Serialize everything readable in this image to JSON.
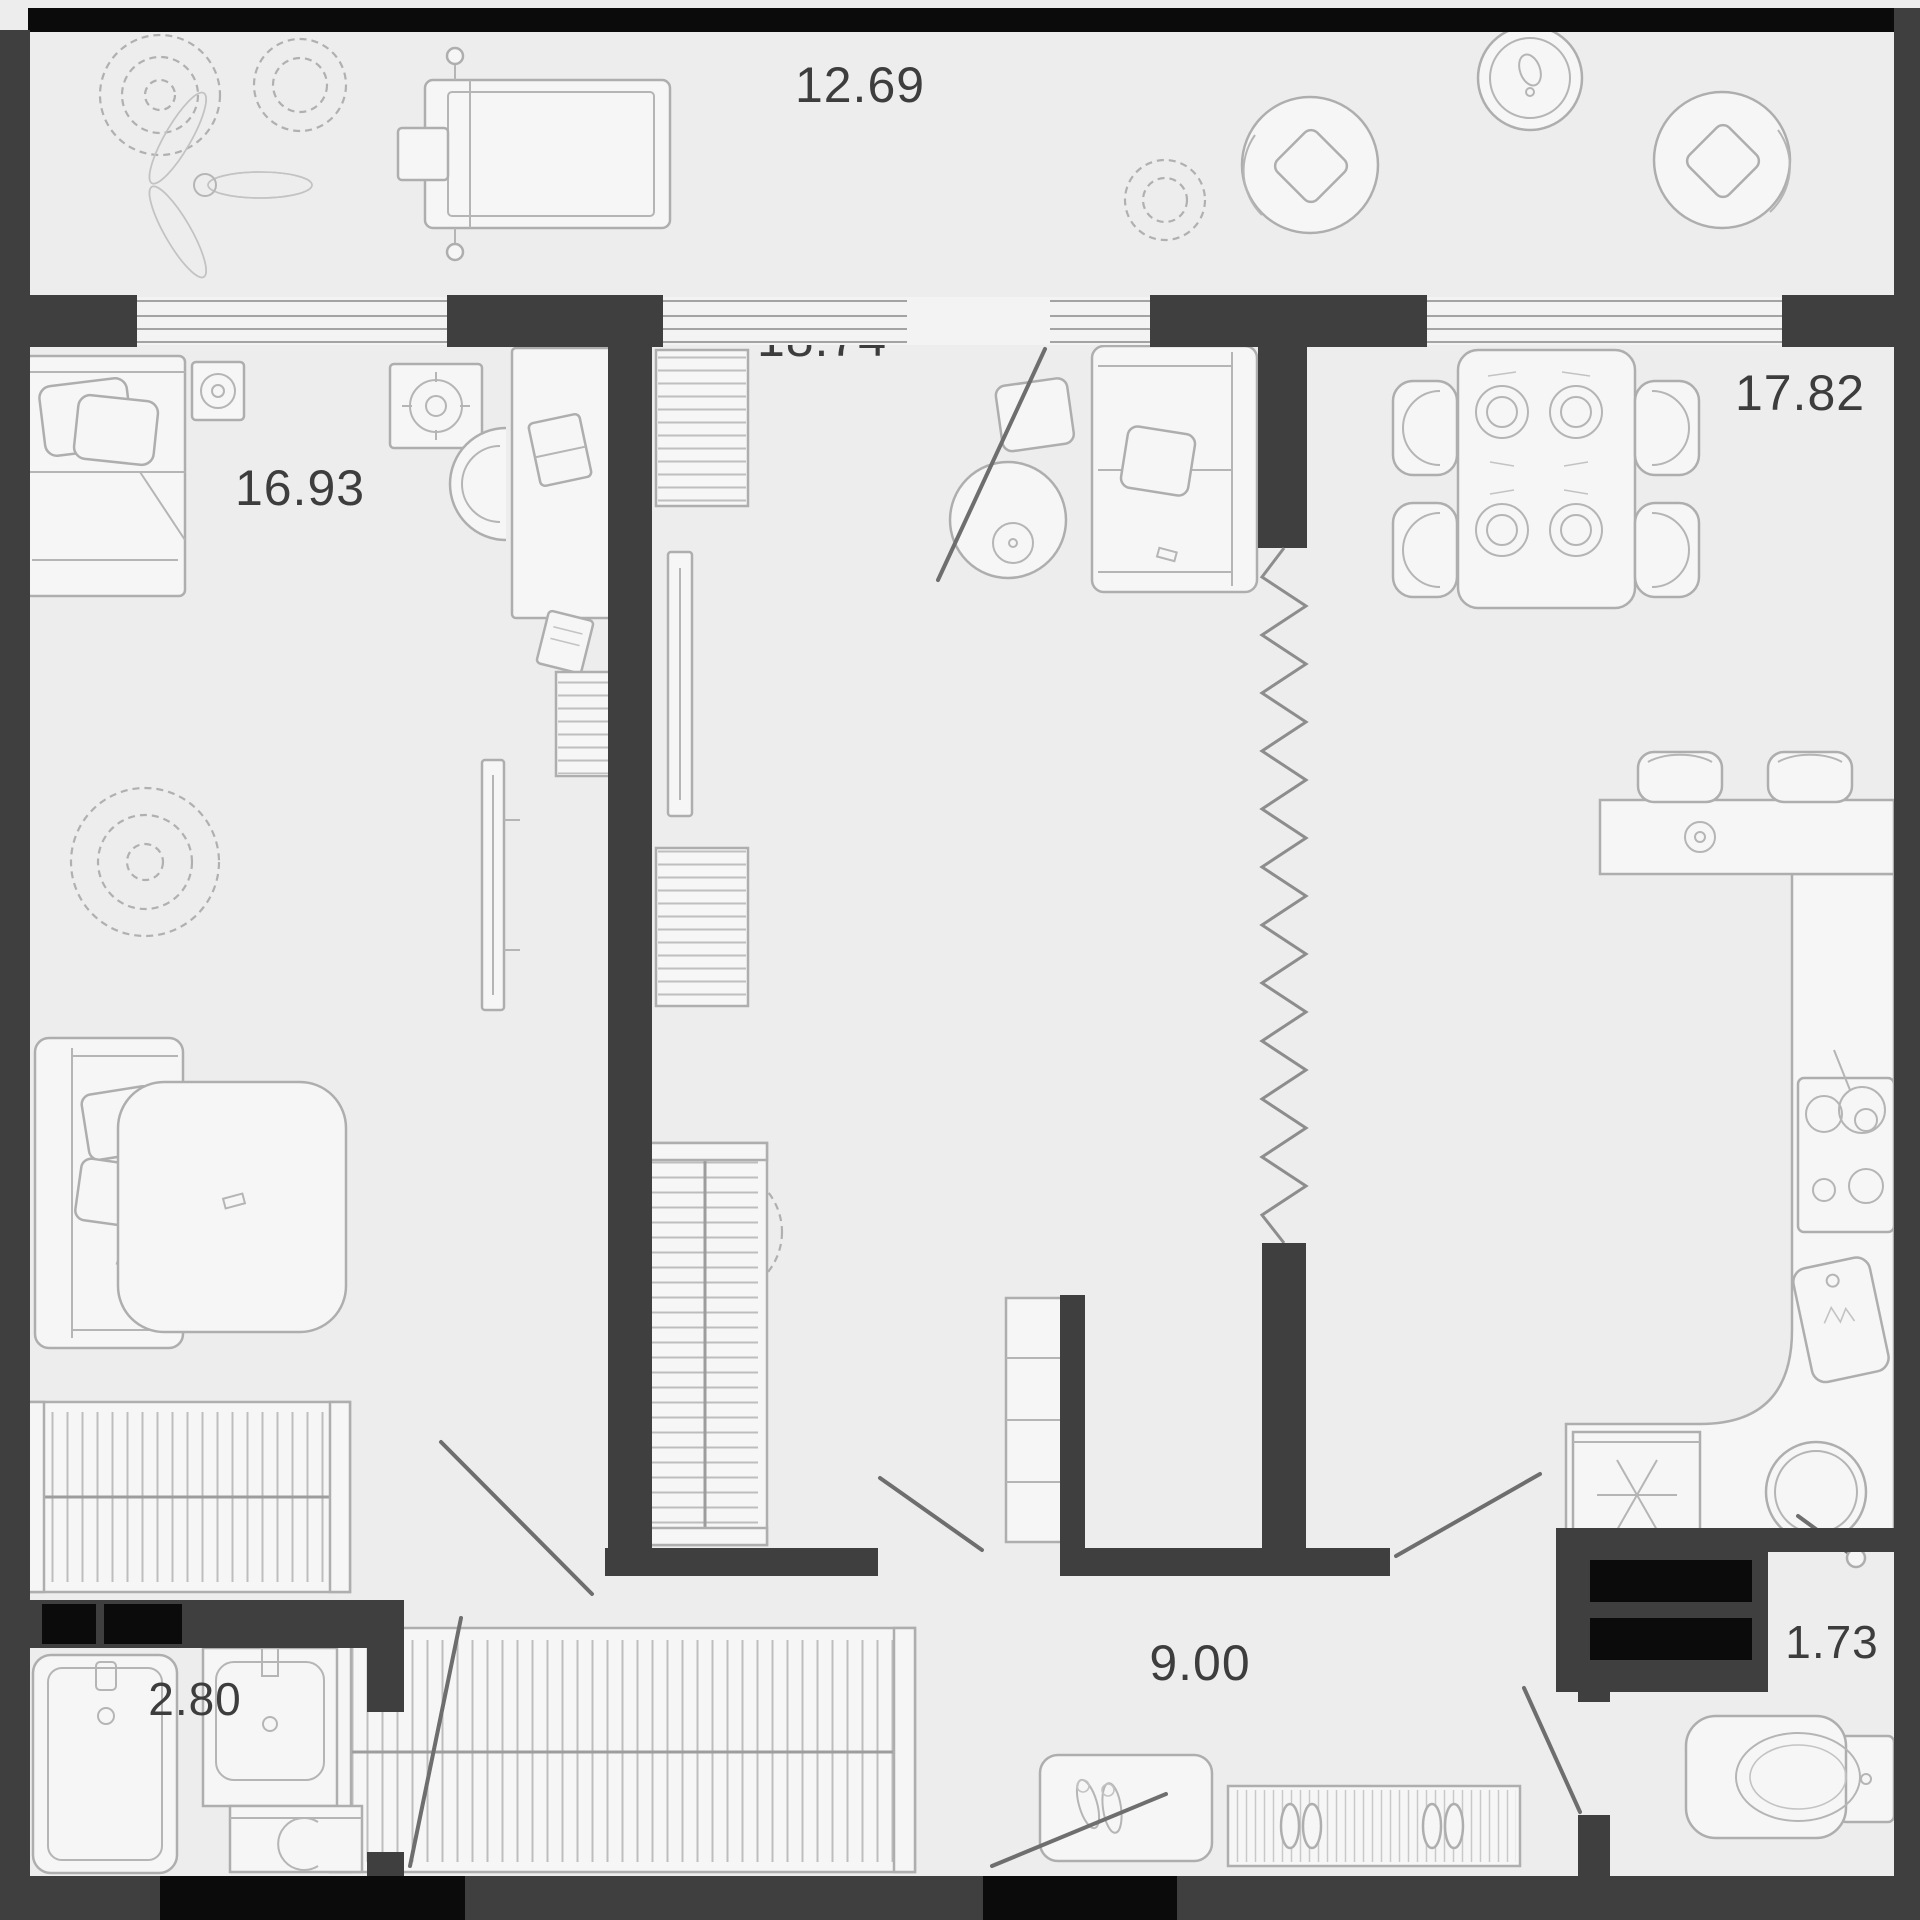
{
  "plan": {
    "type": "apartment-floor-plan",
    "rooms": [
      {
        "id": "balcony",
        "area_label": "12.69"
      },
      {
        "id": "bedroom",
        "area_label": "16.93"
      },
      {
        "id": "living_room",
        "area_label": "18.74"
      },
      {
        "id": "kitchen_dining",
        "area_label": "17.82"
      },
      {
        "id": "hallway",
        "area_label": "9.00"
      },
      {
        "id": "bathroom",
        "area_label": "2.80"
      },
      {
        "id": "wc",
        "area_label": "1.73"
      }
    ],
    "labels": {
      "balcony": "12.69",
      "bedroom": "16.93",
      "living_room": "18.74",
      "kitchen_dining": "17.82",
      "hallway": "9.00",
      "bathroom": "2.80",
      "wc": "1.73"
    },
    "colors": {
      "wall": "#3f3f3f",
      "shaft_black": "#0b0b0b",
      "floor": "#ededed",
      "furniture_line": "#aeaeae",
      "label_text": "#3d3d3d"
    }
  }
}
